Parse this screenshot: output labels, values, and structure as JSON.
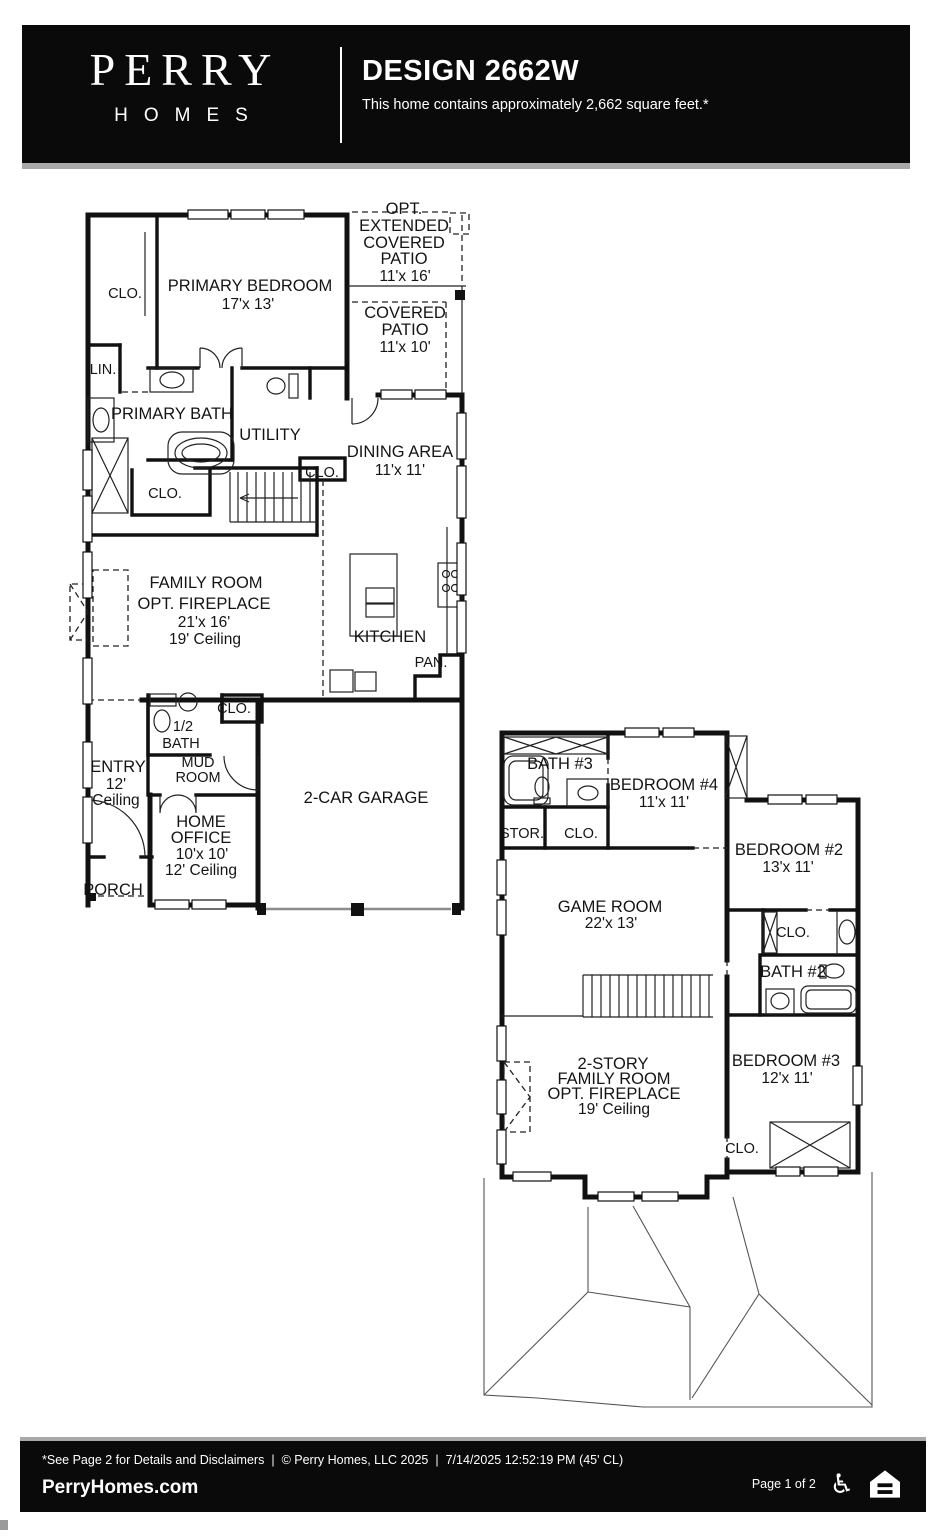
{
  "header": {
    "brand_line1": "PERRY",
    "brand_line2": "HOMES",
    "title": "DESIGN 2662W",
    "subtitle": "This home contains approximately 2,662 square feet.*"
  },
  "floor1": {
    "clo1": "CLO.",
    "primary_bedroom": {
      "name": "PRIMARY BEDROOM",
      "dims": "17'x 13'"
    },
    "opt_patio": {
      "l1": "OPT.",
      "l2": "EXTENDED",
      "l3": "COVERED",
      "l4": "PATIO",
      "dims": "11'x 16'"
    },
    "covered_patio": {
      "l1": "COVERED",
      "l2": "PATIO",
      "dims": "11'x 10'"
    },
    "lin": "LIN.",
    "primary_bath": "PRIMARY BATH",
    "utility": "UTILITY",
    "clo_utility": "CLO.",
    "dining": {
      "name": "DINING AREA",
      "dims": "11'x 11'"
    },
    "clo_primary": "CLO.",
    "family_room": {
      "l1": "FAMILY ROOM",
      "l2": "OPT. FIREPLACE",
      "dims": "21'x 16'",
      "ceiling": "19' Ceiling"
    },
    "kitchen": "KITCHEN",
    "pantry": "PAN.",
    "half_bath": {
      "l1": "1/2",
      "l2": "BATH"
    },
    "clo_hall": "CLO.",
    "mud_room": {
      "l1": "MUD",
      "l2": "ROOM"
    },
    "entry": {
      "l1": "ENTRY",
      "l2": "12'",
      "l3": "Ceiling"
    },
    "home_office": {
      "l1": "HOME",
      "l2": "OFFICE",
      "dims": "10'x 10'",
      "ceiling": "12' Ceiling"
    },
    "porch": "PORCH",
    "garage": "2-CAR GARAGE"
  },
  "floor2": {
    "bath3": "BATH #3",
    "bedroom4": {
      "name": "BEDROOM #4",
      "dims": "11'x 11'"
    },
    "stor": "STOR.",
    "clo_b4": "CLO.",
    "bedroom2": {
      "name": "BEDROOM #2",
      "dims": "13'x 11'"
    },
    "game_room": {
      "name": "GAME ROOM",
      "dims": "22'x 13'"
    },
    "clo_b2": "CLO.",
    "bath2": "BATH #2",
    "family_room": {
      "l1": "2-STORY",
      "l2": "FAMILY ROOM",
      "l3": "OPT. FIREPLACE",
      "ceiling": "19' Ceiling"
    },
    "bedroom3": {
      "name": "BEDROOM #3",
      "dims": "12'x 11'"
    },
    "clo_b3": "CLO."
  },
  "footer": {
    "disclaimer": "*See Page 2 for Details and Disclaimers",
    "sep1": "|",
    "copyright": "© Perry Homes, LLC 2025",
    "sep2": "|",
    "timestamp": "7/14/2025 12:52:19 PM",
    "plan_note": "(45' CL)",
    "website": "PerryHomes.com",
    "page_indicator": "Page 1 of 2"
  },
  "icons": {
    "accessibility": "♿"
  },
  "colors": {
    "header_bg": "#0a0a0a",
    "divider_gray": "#a9a9a9",
    "line": "#111111"
  }
}
